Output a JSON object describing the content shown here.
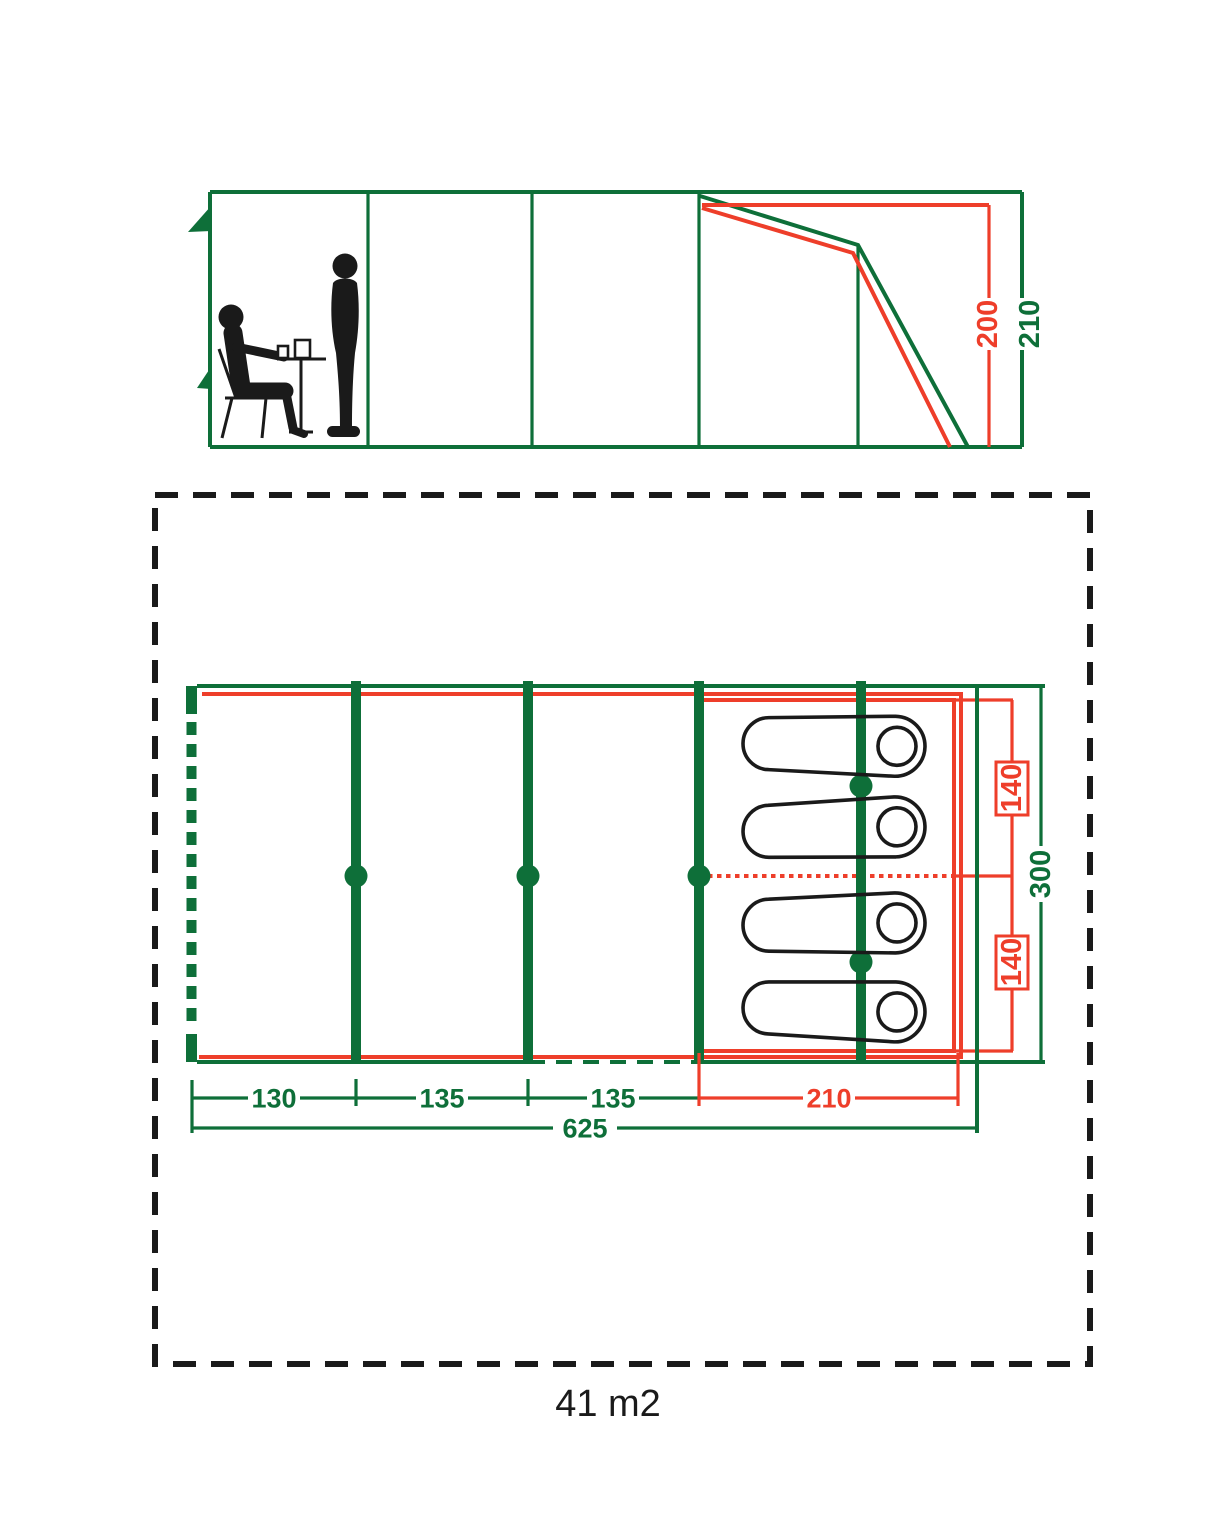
{
  "colors": {
    "green": "#0e6f39",
    "red": "#ee3e2a",
    "black": "#1a1a1a",
    "background": "#ffffff"
  },
  "elevation": {
    "dimensions": [
      {
        "label": "200",
        "color": "red",
        "meaning": "inner cabin height"
      },
      {
        "label": "210",
        "color": "green",
        "meaning": "outer tent height"
      }
    ]
  },
  "plan": {
    "area_label": "41 m2",
    "length_segments": [
      {
        "label": "130",
        "color": "green"
      },
      {
        "label": "135",
        "color": "green"
      },
      {
        "label": "135",
        "color": "green"
      },
      {
        "label": "210",
        "color": "red"
      }
    ],
    "total_length": {
      "label": "625",
      "color": "green"
    },
    "bed_widths": [
      {
        "label": "140",
        "color": "red"
      },
      {
        "label": "140",
        "color": "red"
      }
    ],
    "total_width": {
      "label": "300",
      "color": "green"
    },
    "sleeping_bag_count": 4
  },
  "icons": {
    "seated_person": "person-seated-at-table-icon",
    "standing_person": "person-standing-icon",
    "sleeping_bag": "sleeping-bag-icon",
    "vent_flag": "vent-flag-icon"
  }
}
